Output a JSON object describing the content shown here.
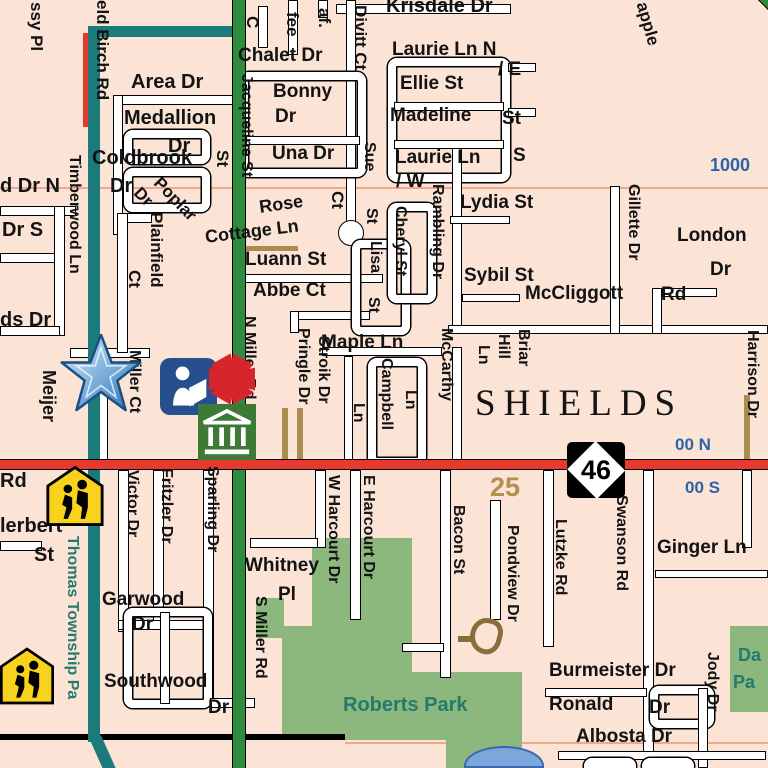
{
  "map": {
    "place_name": "SHIELDS",
    "route_marker": {
      "number": "46"
    },
    "colors": {
      "background": "#fbe3d6",
      "blue": "#2a65a8",
      "tan": "#b2914e",
      "teal": "#257a6e",
      "road_teal": "#1b7a7a",
      "road_green": "#2f8b3d",
      "road_red": "#e8392e",
      "park_green": "#8cb87d",
      "pond_blue": "#7ba7dc",
      "label_black": "#131313"
    },
    "icons": [
      {
        "name": "meijer-star-icon",
        "meaning": "point of interest star"
      },
      {
        "name": "library-icon",
        "meaning": "public library"
      },
      {
        "name": "red-asterisk-icon",
        "meaning": "point of interest"
      },
      {
        "name": "government-building-icon",
        "meaning": "township hall / public building"
      },
      {
        "name": "school-crossing-icon",
        "meaning": "school"
      },
      {
        "name": "school-crossing-icon",
        "meaning": "school"
      },
      {
        "name": "route-46-marker",
        "meaning": "highway M-46"
      }
    ],
    "labels": [
      {
        "t": "ssy Pl",
        "x": 28,
        "y": 2,
        "v": 1,
        "fs": 17
      },
      {
        "t": "eld Birch Rd",
        "x": 94,
        "y": 0,
        "v": 1,
        "fs": 17
      },
      {
        "t": "Area Dr",
        "x": 131,
        "y": 72,
        "fs": 20
      },
      {
        "t": "Medallion",
        "x": 124,
        "y": 108,
        "fs": 20
      },
      {
        "t": "Dr",
        "x": 168,
        "y": 136,
        "fs": 20
      },
      {
        "t": "Coldbrook",
        "x": 92,
        "y": 148,
        "fs": 20
      },
      {
        "t": "Dr",
        "x": 110,
        "y": 176,
        "fs": 20
      },
      {
        "t": "d Dr N",
        "x": 0,
        "y": 176,
        "fs": 20
      },
      {
        "t": "Dr S",
        "x": 2,
        "y": 220,
        "fs": 20
      },
      {
        "t": "ds Dr",
        "x": 0,
        "y": 310,
        "fs": 20
      },
      {
        "t": "Timberwood Ln",
        "x": 66,
        "y": 155,
        "v": 1,
        "fs": 16
      },
      {
        "t": "Plainfield",
        "x": 148,
        "y": 212,
        "v": 1,
        "fs": 17
      },
      {
        "t": "Ct",
        "x": 126,
        "y": 270,
        "v": 1,
        "fs": 17
      },
      {
        "t": "Poplar",
        "x": 163,
        "y": 174,
        "r": 46,
        "fs": 17
      },
      {
        "t": "Dr",
        "x": 143,
        "y": 184,
        "r": 46,
        "fs": 17
      },
      {
        "t": "St",
        "x": 214,
        "y": 150,
        "v": 1,
        "fs": 17
      },
      {
        "t": "C",
        "x": 244,
        "y": 16,
        "v": 1,
        "fs": 17
      },
      {
        "t": "fee",
        "x": 284,
        "y": 12,
        "v": 1,
        "fs": 17
      },
      {
        "t": "af.",
        "x": 316,
        "y": 8,
        "v": 1,
        "fs": 17
      },
      {
        "t": "Chalet Dr",
        "x": 238,
        "y": 46,
        "fs": 19
      },
      {
        "t": "Divitt Ct",
        "x": 352,
        "y": 5,
        "v": 1,
        "fs": 17
      },
      {
        "t": "Krisdale Dr",
        "x": 386,
        "y": -4,
        "fs": 20
      },
      {
        "t": "Laurie Ln N",
        "x": 392,
        "y": 40,
        "fs": 19
      },
      {
        "t": "/ E",
        "x": 498,
        "y": 60,
        "fs": 19
      },
      {
        "t": "Ellie St",
        "x": 400,
        "y": 74,
        "fs": 19
      },
      {
        "t": "Madeline",
        "x": 390,
        "y": 106,
        "fs": 19
      },
      {
        "t": "St",
        "x": 502,
        "y": 109,
        "fs": 19
      },
      {
        "t": "Laurie Ln",
        "x": 395,
        "y": 148,
        "fs": 19
      },
      {
        "t": "S",
        "x": 513,
        "y": 146,
        "fs": 19
      },
      {
        "t": "/ W",
        "x": 396,
        "y": 172,
        "fs": 19
      },
      {
        "t": "Jacqueline St",
        "x": 238,
        "y": 74,
        "v": 1,
        "fs": 16
      },
      {
        "t": "Bonny",
        "x": 273,
        "y": 82,
        "fs": 19
      },
      {
        "t": "Dr",
        "x": 275,
        "y": 107,
        "fs": 19
      },
      {
        "t": "Una Dr",
        "x": 272,
        "y": 144,
        "fs": 19
      },
      {
        "t": "Sue",
        "x": 361,
        "y": 142,
        "v": 1,
        "fs": 16
      },
      {
        "t": "St",
        "x": 363,
        "y": 208,
        "v": 1,
        "fs": 16
      },
      {
        "t": "Lisa",
        "x": 367,
        "y": 241,
        "v": 1,
        "fs": 16
      },
      {
        "t": "St",
        "x": 365,
        "y": 297,
        "v": 1,
        "fs": 16
      },
      {
        "t": "Rose",
        "x": 258,
        "y": 198,
        "r": -8,
        "fs": 18
      },
      {
        "t": "Ct",
        "x": 329,
        "y": 191,
        "v": 1,
        "fs": 17
      },
      {
        "t": "Cottage Ln",
        "x": 204,
        "y": 228,
        "r": -7,
        "fs": 18
      },
      {
        "t": "Luann St",
        "x": 245,
        "y": 250,
        "fs": 19
      },
      {
        "t": "Abbe Ct",
        "x": 253,
        "y": 281,
        "fs": 19
      },
      {
        "t": "Cheryl St",
        "x": 392,
        "y": 206,
        "v": 1,
        "fs": 16
      },
      {
        "t": "Rambling Dr",
        "x": 429,
        "y": 184,
        "v": 1,
        "fs": 16
      },
      {
        "t": "Lydia St",
        "x": 460,
        "y": 193,
        "fs": 19
      },
      {
        "t": "Sybil St",
        "x": 464,
        "y": 266,
        "fs": 19
      },
      {
        "t": "apple",
        "x": 650,
        "y": 0,
        "r": 74,
        "fs": 17
      },
      {
        "t": "1000",
        "x": 710,
        "y": 156,
        "fs": 18,
        "c": "blue"
      },
      {
        "t": "Gillette Dr",
        "x": 625,
        "y": 184,
        "v": 1,
        "fs": 16
      },
      {
        "t": "London",
        "x": 677,
        "y": 226,
        "fs": 19
      },
      {
        "t": "Dr",
        "x": 710,
        "y": 260,
        "fs": 19
      },
      {
        "t": "McCliggott",
        "x": 525,
        "y": 284,
        "fs": 19
      },
      {
        "t": "Rd",
        "x": 661,
        "y": 285,
        "fs": 19
      },
      {
        "t": "Maple Ln",
        "x": 321,
        "y": 333,
        "fs": 19
      },
      {
        "t": "Ln",
        "x": 350,
        "y": 403,
        "v": 1,
        "fs": 16
      },
      {
        "t": "Campbell",
        "x": 378,
        "y": 358,
        "v": 1,
        "fs": 16
      },
      {
        "t": "Ln",
        "x": 402,
        "y": 390,
        "v": 1,
        "fs": 16
      },
      {
        "t": "McCarthy",
        "x": 438,
        "y": 328,
        "v": 1,
        "fs": 16
      },
      {
        "t": "Briar",
        "x": 515,
        "y": 329,
        "v": 1,
        "fs": 16
      },
      {
        "t": "Hill",
        "x": 495,
        "y": 334,
        "v": 1,
        "fs": 16
      },
      {
        "t": "Ln",
        "x": 475,
        "y": 345,
        "v": 1,
        "fs": 16
      },
      {
        "t": "Pringle Dr",
        "x": 295,
        "y": 328,
        "v": 1,
        "fs": 16
      },
      {
        "t": "Stroik Dr",
        "x": 315,
        "y": 336,
        "v": 1,
        "fs": 16
      },
      {
        "t": "N Miller Rd",
        "x": 241,
        "y": 316,
        "v": 1,
        "fs": 16
      },
      {
        "t": "Meijer",
        "x": 40,
        "y": 370,
        "v": 1,
        "fs": 18
      },
      {
        "t": "Miller Ct",
        "x": 126,
        "y": 350,
        "v": 1,
        "fs": 16
      },
      {
        "t": "SHIELDS",
        "x": 475,
        "y": 385,
        "fs": 37,
        "cls": "shields"
      },
      {
        "t": "00 N",
        "x": 675,
        "y": 436,
        "fs": 17,
        "c": "blue"
      },
      {
        "t": "00 S",
        "x": 685,
        "y": 479,
        "fs": 17,
        "c": "blue"
      },
      {
        "t": "Harrison Dr",
        "x": 744,
        "y": 330,
        "v": 1,
        "fs": 16
      },
      {
        "t": "25",
        "x": 490,
        "y": 474,
        "fs": 27,
        "c": "tan"
      },
      {
        "t": "Rd",
        "x": 0,
        "y": 471,
        "fs": 20
      },
      {
        "t": "lerbert",
        "x": 0,
        "y": 516,
        "fs": 20
      },
      {
        "t": "St",
        "x": 34,
        "y": 545,
        "fs": 20
      },
      {
        "t": "Thomas Township Pa",
        "x": 64,
        "y": 536,
        "v": 1,
        "fs": 16,
        "c": "teal"
      },
      {
        "t": "Victor Dr",
        "x": 124,
        "y": 470,
        "v": 1,
        "fs": 16
      },
      {
        "t": "Fritzler Dr",
        "x": 158,
        "y": 468,
        "v": 1,
        "fs": 16
      },
      {
        "t": "Sparling Dr",
        "x": 204,
        "y": 466,
        "v": 1,
        "fs": 16
      },
      {
        "t": "Garwood",
        "x": 102,
        "y": 590,
        "fs": 19
      },
      {
        "t": "Dr",
        "x": 132,
        "y": 615,
        "fs": 19
      },
      {
        "t": "Southwood",
        "x": 104,
        "y": 672,
        "fs": 19
      },
      {
        "t": "Dr",
        "x": 208,
        "y": 698,
        "fs": 19
      },
      {
        "t": "S Miller Rd",
        "x": 252,
        "y": 596,
        "v": 1,
        "fs": 16
      },
      {
        "t": "Whitney",
        "x": 245,
        "y": 556,
        "fs": 19
      },
      {
        "t": "Pl",
        "x": 278,
        "y": 585,
        "fs": 19
      },
      {
        "t": "W Harcourt Dr",
        "x": 325,
        "y": 475,
        "v": 1,
        "fs": 16
      },
      {
        "t": "E Harcourt Dr",
        "x": 360,
        "y": 475,
        "v": 1,
        "fs": 16
      },
      {
        "t": "Bacon St",
        "x": 450,
        "y": 505,
        "v": 1,
        "fs": 16
      },
      {
        "t": "Pondview Dr",
        "x": 504,
        "y": 525,
        "v": 1,
        "fs": 16
      },
      {
        "t": "Lutzke Rd",
        "x": 552,
        "y": 519,
        "v": 1,
        "fs": 16
      },
      {
        "t": "Swanson Rd",
        "x": 613,
        "y": 495,
        "v": 1,
        "fs": 16
      },
      {
        "t": "Ginger Ln",
        "x": 657,
        "y": 538,
        "fs": 19
      },
      {
        "t": "Roberts Park",
        "x": 343,
        "y": 695,
        "fs": 20,
        "c": "teal"
      },
      {
        "t": "Burmeister Dr",
        "x": 549,
        "y": 661,
        "fs": 19
      },
      {
        "t": "Ronald",
        "x": 549,
        "y": 695,
        "fs": 19
      },
      {
        "t": "Dr",
        "x": 649,
        "y": 698,
        "fs": 19
      },
      {
        "t": "Albosta Dr",
        "x": 576,
        "y": 727,
        "fs": 19
      },
      {
        "t": "Jody Dr",
        "x": 704,
        "y": 652,
        "v": 1,
        "fs": 16
      },
      {
        "t": "Da",
        "x": 738,
        "y": 646,
        "fs": 18,
        "c": "teal"
      },
      {
        "t": "Pa",
        "x": 733,
        "y": 673,
        "fs": 18,
        "c": "teal"
      }
    ]
  }
}
